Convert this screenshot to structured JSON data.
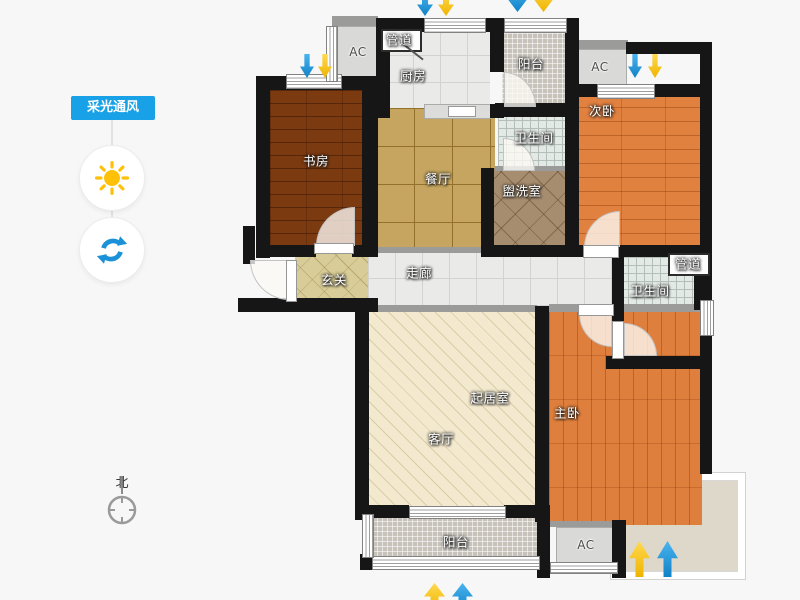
{
  "panel": {
    "toggle_label": "采光通风"
  },
  "compass": {
    "north": "北"
  },
  "rooms": {
    "study": "书房",
    "kitchen": "厨房",
    "dining": "餐厅",
    "balcony_top": "阳台",
    "bath_top": "卫生间",
    "washroom": "盥洗室",
    "bedroom2": "次卧",
    "entry": "玄关",
    "corridor": "走廊",
    "bath_right": "卫生间",
    "living": "起居室",
    "living_alt": "客厅",
    "master": "主卧",
    "balcony_bottom": "阳台"
  },
  "labels": {
    "duct_top": "管道",
    "duct_right": "管道",
    "ac_top_left": "AC",
    "ac_top_right": "AC",
    "ac_bottom": "AC"
  },
  "colors": {
    "accent_blue": "#18a1e6",
    "sun_yellow": "#ffc107",
    "arrow_blue": "#2aa4e8",
    "arrow_yellow": "#ffc913",
    "wall": "#161616"
  }
}
